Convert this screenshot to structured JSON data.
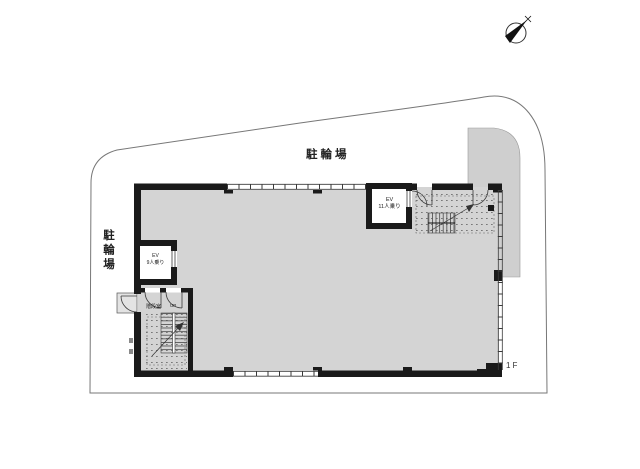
{
  "plan": {
    "type": "architectural-floor-plan",
    "floor_label": "1F",
    "labels": {
      "bike_parking_top": "駐輪場",
      "bike_parking_left": "駐輪場",
      "stair_room": "階段室",
      "stair_up": "UP"
    },
    "elevators": {
      "left": {
        "line1": "EV",
        "line2": "9人乗り"
      },
      "right": {
        "line1": "EV",
        "line2": "11人乗り"
      }
    },
    "icons": {
      "north_arrow": "north-arrow-compass"
    },
    "colors": {
      "page": "#ffffff",
      "wall": "#1a1a1a",
      "line": "#3a3a3a",
      "floor": "#d4d4d4",
      "paving": "#cfcfcf",
      "boundary": "#777777",
      "text": "#222222"
    }
  }
}
